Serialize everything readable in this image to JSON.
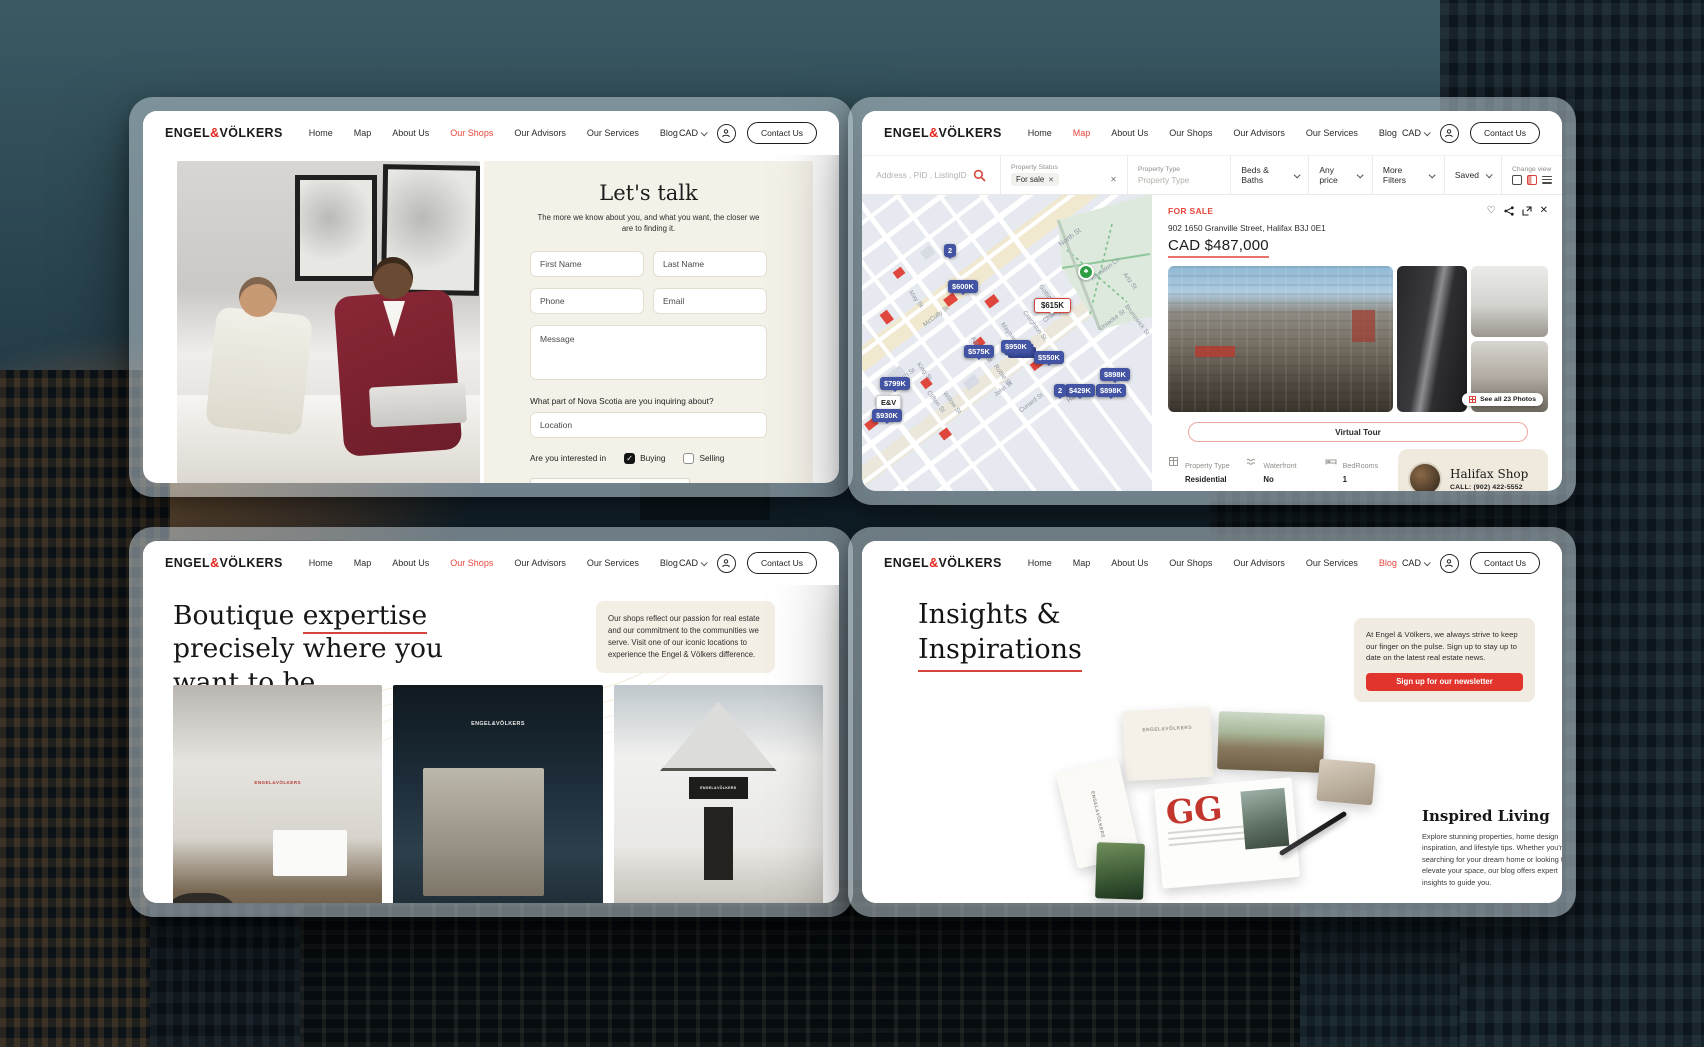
{
  "colors": {
    "brand_red": "#e4251c",
    "accent_red": "#d6453c",
    "pin_blue": "#4254a3",
    "beige_panel": "#f4f1e8"
  },
  "nav": {
    "logo": {
      "p1": "ENGEL",
      "amp": "&",
      "p2": "VÖLKERS"
    },
    "items": [
      "Home",
      "Map",
      "About Us",
      "Our Shops",
      "Our Advisors",
      "Our Services",
      "Blog"
    ],
    "currency": "CAD",
    "contact": "Contact Us"
  },
  "contact_page": {
    "heading": "Let's talk",
    "subheading": "The more we know about you, and what you want, the closer we are to finding it.",
    "fields": {
      "first_name": "First Name",
      "last_name": "Last Name",
      "phone": "Phone",
      "email": "Email",
      "message": "Message"
    },
    "location_label": "What part of Nova Scotia are you inquiring about?",
    "location_placeholder": "Location",
    "interest_label": "Are you interested in",
    "interest_options": [
      {
        "label": "Buying",
        "checked": true
      },
      {
        "label": "Selling",
        "checked": false
      }
    ],
    "captcha_label": "Я не робот",
    "captcha_check": "✓"
  },
  "map_page": {
    "filters": {
      "search_placeholder": "Address , PID , ListingID",
      "status_label": "Property Status",
      "status_value": "For sale",
      "status_chip_x": "✕",
      "clear_x": "✕",
      "type_label": "Property Type",
      "type_placeholder": "Property Type",
      "beds_baths": "Beds & Baths",
      "any_price": "Any price",
      "more_filters": "More Filters",
      "saved": "Saved",
      "change_view": "Change view"
    },
    "map": {
      "pins": [
        {
          "label": "2"
        },
        {
          "label": "$600K"
        },
        {
          "label": "$615K",
          "selected": true
        },
        {
          "label": "$575K"
        },
        {
          "label": "$950K"
        },
        {
          "label": "$550K"
        },
        {
          "label": "$799K"
        },
        {
          "label": "$898K"
        },
        {
          "label": "$898K"
        },
        {
          "label": "2"
        },
        {
          "label": "$429K"
        },
        {
          "label": "E&V"
        },
        {
          "label": "$930K"
        }
      ],
      "park_marker": "♣",
      "streets": [
        "North St",
        "Hamilton Ln",
        "Artz St",
        "Gottingen St",
        "Brunswick St",
        "Uniacke St",
        "Creighton St",
        "Maynard St",
        "Charles St",
        "Agricola St",
        "May St",
        "McCully St",
        "King St",
        "Clifton St",
        "Willow St",
        "Robie St",
        "John St",
        "Harris St",
        "Cunard St",
        "North St"
      ]
    },
    "listing": {
      "status": "FOR SALE",
      "heart": "♡",
      "close": "✕",
      "address": "902 1650 Granville Street, Halifax B3J 0E1",
      "price": "CAD $487,000",
      "see_all_photos": "See all 23 Photos",
      "virtual_tour": "Virtual Tour",
      "details": [
        {
          "label": "Property Type",
          "value": "Residential"
        },
        {
          "label": "Waterfront",
          "value": "No"
        },
        {
          "label": "BedRooms",
          "value": "1"
        },
        {
          "label": "BathRooms",
          "value": ""
        },
        {
          "label": "MLA/TLA (Sq.ft)",
          "value": ""
        },
        {
          "label": "Price/Sq.ft",
          "value": ""
        }
      ],
      "shop": {
        "name": "Halifax Shop",
        "phone": "CALL: (902) 422-5552"
      }
    }
  },
  "shops_page": {
    "heading_word1": "Boutique",
    "heading_underlined": "expertise",
    "heading_line2": "precisely where you",
    "heading_line3": "want to be.",
    "card_text": "Our shops reflect our passion for real estate and our commitment to the communities we serve. Visit one of our iconic locations to experience the Engel & Völkers difference.",
    "photo_signs": [
      "ENGEL&VÖLKERS",
      "ENGEL&VÖLKERS",
      "ENGEL&VÖLKERS"
    ]
  },
  "blog_page": {
    "heading_line1": "Insights &",
    "heading_line2": "Inspirations",
    "newsletter_text": "At Engel & Völkers, we always strive to keep our finger on the pulse. Sign up to stay up to date on the latest real estate news.",
    "newsletter_button": "Sign up for our newsletter",
    "letterhead_a": "ENGEL&VÖLKERS",
    "letterhead_b": "ENGEL&VÖLKERS",
    "magazine_initials": "GG",
    "article_title": "Inspired Living",
    "article_text": "Explore stunning properties, home design inspiration, and lifestyle tips. Whether you're searching for your dream home or looking to elevate your space, our blog offers expert insights to guide you."
  }
}
